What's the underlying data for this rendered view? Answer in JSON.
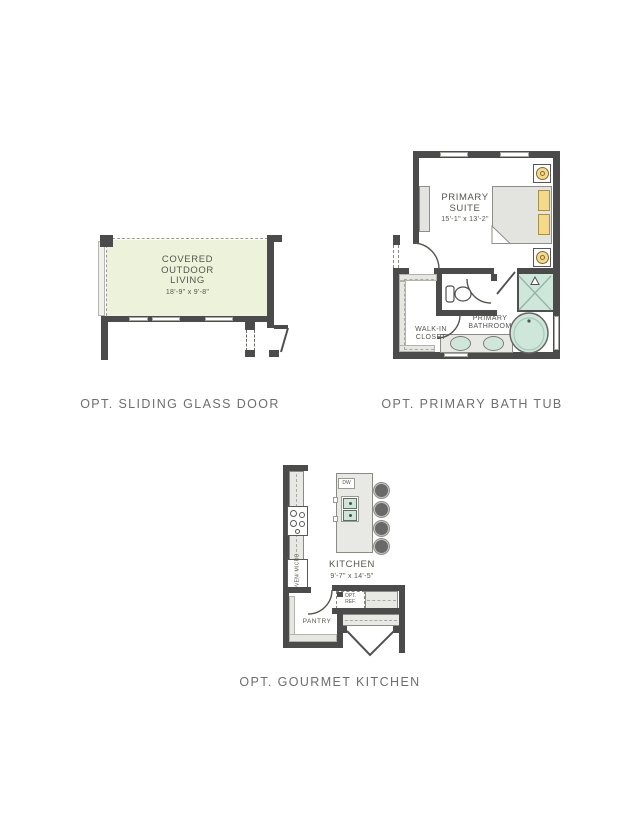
{
  "colors": {
    "wall": "#4b4b4b",
    "patio-green": "#edf2db",
    "fixture-teal": "#cfe7db",
    "accent-yellow": "#f5d98b",
    "furniture-gray": "#e3e3e0",
    "counter-gray": "#e8e8e4",
    "plan-text": "#55564e",
    "caption-text": "#6e6e6e"
  },
  "captions": {
    "plan1": "OPT. SLIDING GLASS DOOR",
    "plan2": "OPT. PRIMARY BATH TUB",
    "plan3": "OPT. GOURMET KITCHEN"
  },
  "plan1": {
    "room": {
      "line1": "COVERED",
      "line2": "OUTDOOR",
      "line3": "LIVING",
      "dims": "18'-9\" x 9'-8\""
    }
  },
  "plan2": {
    "suite": {
      "line1": "PRIMARY",
      "line2": "SUITE",
      "dims": "15'-1\" x 13'-2\""
    },
    "closet": {
      "line1": "WALK-IN",
      "line2": "CLOSET"
    },
    "bath": {
      "line1": "PRIMARY",
      "line2": "BATHROOM"
    }
  },
  "plan3": {
    "kitchen": {
      "name": "KITCHEN",
      "dims": "9'-7\" x 14'-5\""
    },
    "pantry": {
      "name": "PANTRY"
    },
    "island": {
      "dw": "DW"
    },
    "appliances": {
      "oven": "OVEN/",
      "micro": "MICRO",
      "ref_line1": "OPT.",
      "ref_line2": "REF."
    }
  }
}
